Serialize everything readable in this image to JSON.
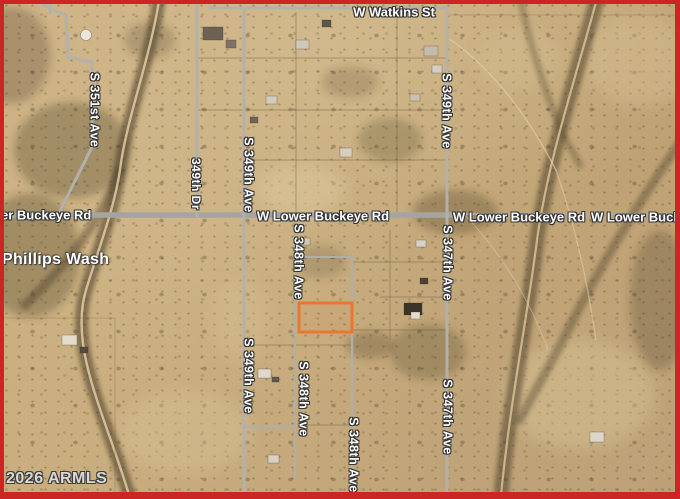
{
  "map": {
    "type": "satellite-parcel-map",
    "border_color": "#cb2524",
    "attribution": "2026 ARMLS",
    "water_feature": "Phillips Wash",
    "parcel_highlight": {
      "color": "#e8782f",
      "x": 299,
      "y": 303,
      "width": 53,
      "height": 29
    },
    "road_color": "#b3b1ac",
    "main_road_color": "#a6a4a0",
    "labels": [
      {
        "text": "W Watkins St",
        "kind": "road-horizontal"
      },
      {
        "text": "er Buckeye Rd",
        "kind": "road-horizontal-clipped-left"
      },
      {
        "text": "W Lower Buckeye Rd",
        "kind": "road-horizontal"
      },
      {
        "text": "W Lower Buckeye Rd",
        "kind": "road-horizontal"
      },
      {
        "text": "W Lower Bucke",
        "kind": "road-horizontal-clipped-right"
      },
      {
        "text": "Phillips Wash",
        "kind": "water"
      },
      {
        "text": "S 351st Ave",
        "kind": "road-vertical"
      },
      {
        "text": "349th Dr",
        "kind": "road-vertical"
      },
      {
        "text": "S 349th Ave",
        "kind": "road-vertical"
      },
      {
        "text": "S 349th Ave",
        "kind": "road-vertical"
      },
      {
        "text": "S 348th Ave",
        "kind": "road-vertical"
      },
      {
        "text": "S 347th Ave",
        "kind": "road-vertical"
      },
      {
        "text": "S 349th Ave",
        "kind": "road-vertical"
      },
      {
        "text": "S 348th Ave",
        "kind": "road-vertical"
      },
      {
        "text": "S 348th Ave",
        "kind": "road-vertical"
      },
      {
        "text": "S 347th Ave",
        "kind": "road-vertical"
      },
      {
        "text": "2026 ARMLS",
        "kind": "watermark"
      }
    ]
  }
}
